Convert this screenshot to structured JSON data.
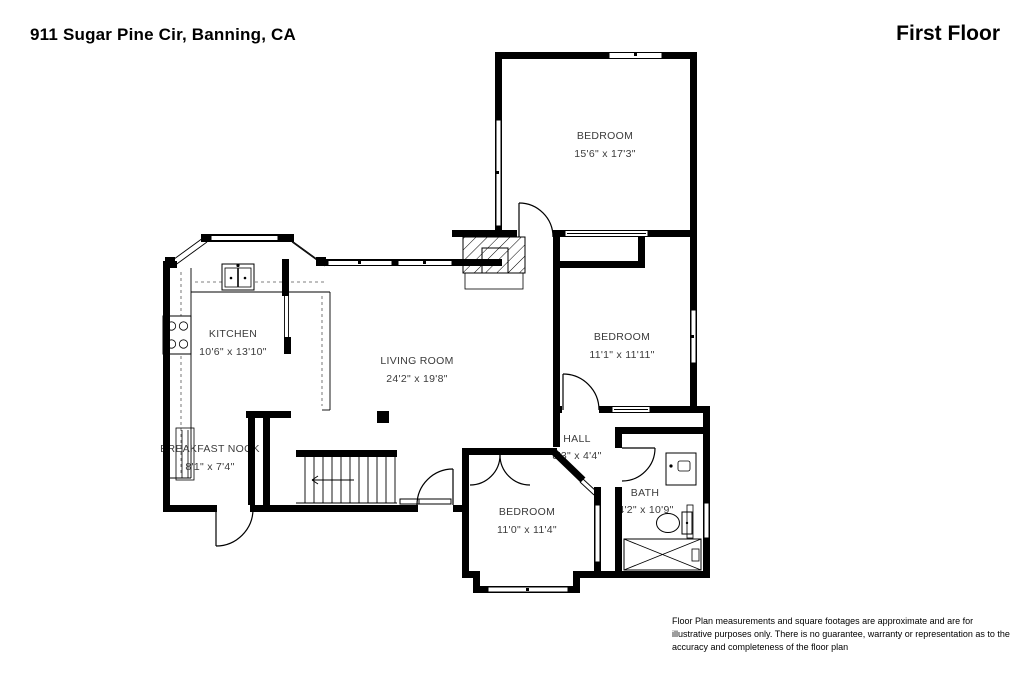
{
  "header": {
    "address": "911 Sugar Pine Cir, Banning, CA",
    "floor_label": "First Floor"
  },
  "rooms": {
    "bedroom1": {
      "name": "BEDROOM",
      "dims": "15'6\" x 17'3\""
    },
    "bedroom2": {
      "name": "BEDROOM",
      "dims": "11'1\" x 11'11\""
    },
    "kitchen": {
      "name": "KITCHEN",
      "dims": "10'6\" x 13'10\""
    },
    "living_room": {
      "name": "LIVING ROOM",
      "dims": "24'2\" x 19'8\""
    },
    "breakfast_nook": {
      "name": "BREAKFAST NOOK",
      "dims": "8'1\" x 7'4\""
    },
    "hall": {
      "name": "HALL",
      "dims": "8'3\" x 4'4\""
    },
    "bedroom3": {
      "name": "BEDROOM",
      "dims": "11'0\" x 11'4\""
    },
    "bath": {
      "name": "BATH",
      "dims": "4'2\" x 10'9\""
    }
  },
  "disclaimer": "Floor Plan measurements and square footages are approximate and are for illustrative purposes only. There is no guarantee, warranty or representation as to the accuracy and completeness of the floor plan",
  "colors": {
    "wall": "#000000",
    "background": "#ffffff",
    "label": "#3b3b3b"
  }
}
